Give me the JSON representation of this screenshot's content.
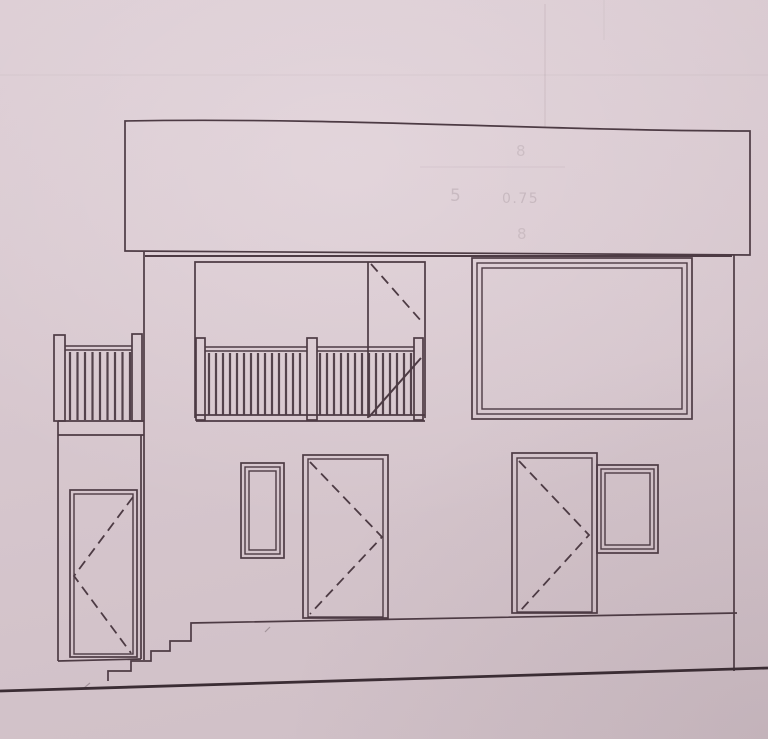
{
  "drawing": {
    "ghost_annotations": {
      "dim_top": "8",
      "dim_left": "5",
      "dim_middle": "0.75",
      "dim_bottom": "8"
    }
  },
  "colors": {
    "paper_top": "#dccdd4",
    "paper_mid": "#d7c7ce",
    "paper_bottom": "#cfbfc6",
    "line": "#4d3b44",
    "line_dark": "#3b2d34"
  }
}
